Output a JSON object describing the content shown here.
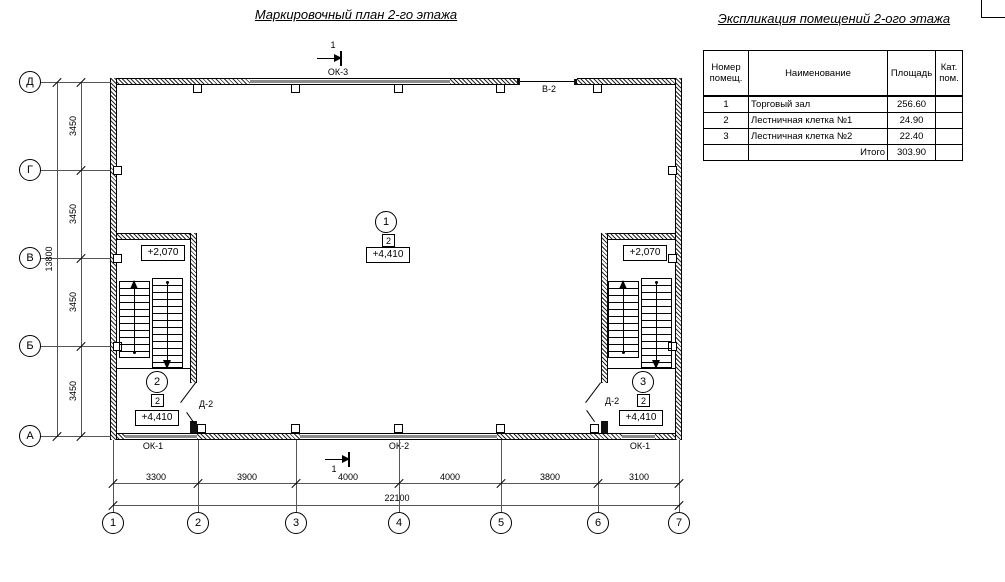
{
  "titles": {
    "plan": "Маркировочный план 2-го этажа",
    "explication": "Экспликация помещений 2-ого этажа"
  },
  "explication_table": {
    "headers": {
      "num": "Номер помещ.",
      "name": "Наименование",
      "area": "Площадь",
      "cat": "Кат. пом."
    },
    "rows": [
      {
        "num": "1",
        "name": "Торговый зал",
        "area": "256.60",
        "cat": ""
      },
      {
        "num": "2",
        "name": "Лестничная клетка №1",
        "area": "24.90",
        "cat": ""
      },
      {
        "num": "3",
        "name": "Лестничная клетка №2",
        "area": "22.40",
        "cat": ""
      },
      {
        "num": "",
        "name": "Итого",
        "area": "303.90",
        "cat": ""
      }
    ]
  },
  "axes": {
    "vertical": [
      "Д",
      "Г",
      "В",
      "Б",
      "А"
    ],
    "horizontal": [
      "1",
      "2",
      "3",
      "4",
      "5",
      "6",
      "7"
    ]
  },
  "dimensions": {
    "left_segments": [
      "3450",
      "3450",
      "3450",
      "3450"
    ],
    "left_total": "13800",
    "bottom_segments": [
      "3300",
      "3900",
      "4000",
      "4000",
      "3800",
      "3100"
    ],
    "bottom_total": "22100"
  },
  "sections": {
    "top": "1",
    "bottom": "1"
  },
  "openings": {
    "window_top": "ОК-3",
    "vent_top": "В-2",
    "window_bottom_left": "ОК-1",
    "window_bottom_center": "ОК-2",
    "window_bottom_right": "ОК-1",
    "door_left": "Д-2",
    "door_right": "Д-2"
  },
  "marks": {
    "hall": {
      "room_number": "1",
      "finish_type": "2",
      "elevation": "+4,410"
    },
    "stair_left": {
      "room_number": "2",
      "finish_type": "2",
      "elevation": "+4,410",
      "mid_elevation": "+2,070"
    },
    "stair_right": {
      "room_number": "3",
      "finish_type": "2",
      "elevation": "+4,410",
      "mid_elevation": "+2,070"
    }
  },
  "colors": {
    "line": "#000000",
    "window_fill": "#8c8c8c",
    "background": "#ffffff"
  }
}
